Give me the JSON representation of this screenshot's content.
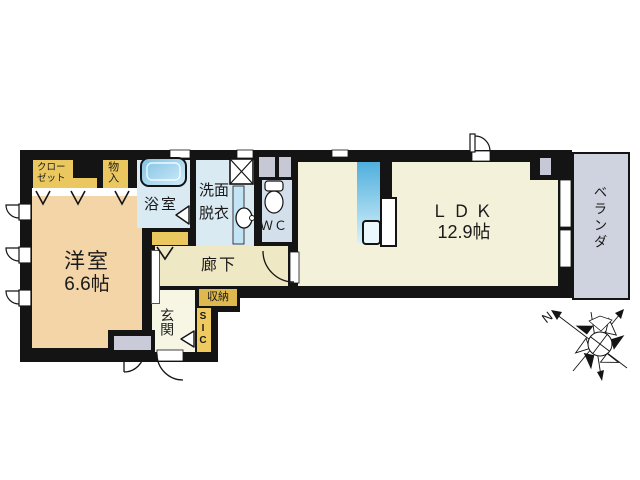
{
  "plan": {
    "rooms": {
      "western_room": {
        "name": "洋室",
        "size": "6.6帖"
      },
      "ldk": {
        "name": "ＬＤＫ",
        "size": "12.9帖"
      },
      "bath": {
        "name": "浴室"
      },
      "washroom": {
        "name_line1": "洗面",
        "name_line2": "脱衣"
      },
      "wc": {
        "name": "ＷＣ"
      },
      "hallway": {
        "name": "廊下"
      },
      "entrance": {
        "name": "玄関"
      },
      "sic": {
        "name": "SIC"
      },
      "storage": {
        "name": "収納"
      },
      "closet": {
        "name_line1": "クロー",
        "name_line2": "ゼット"
      },
      "storage_small": {
        "name": "物入"
      },
      "veranda": {
        "name": "ベランダ"
      }
    },
    "compass": {
      "north": "N"
    },
    "colors": {
      "wall": "#141414",
      "western_room_floor": "#F4D5A8",
      "ldk_floor": "#F3F1DA",
      "hallway_floor": "#EFE8C4",
      "entrance_floor": "#F7F5E4",
      "closet_yellow": "#EBC75F",
      "storage_yellow": "#E0B94E",
      "wet_area_blue": "#D9EAF3",
      "wc_blue": "#D3DFEA",
      "fixture_blue": "#4FAEDC",
      "veranda_gray": "#CFD3DF",
      "service_gray": "#C6C8D6"
    }
  }
}
